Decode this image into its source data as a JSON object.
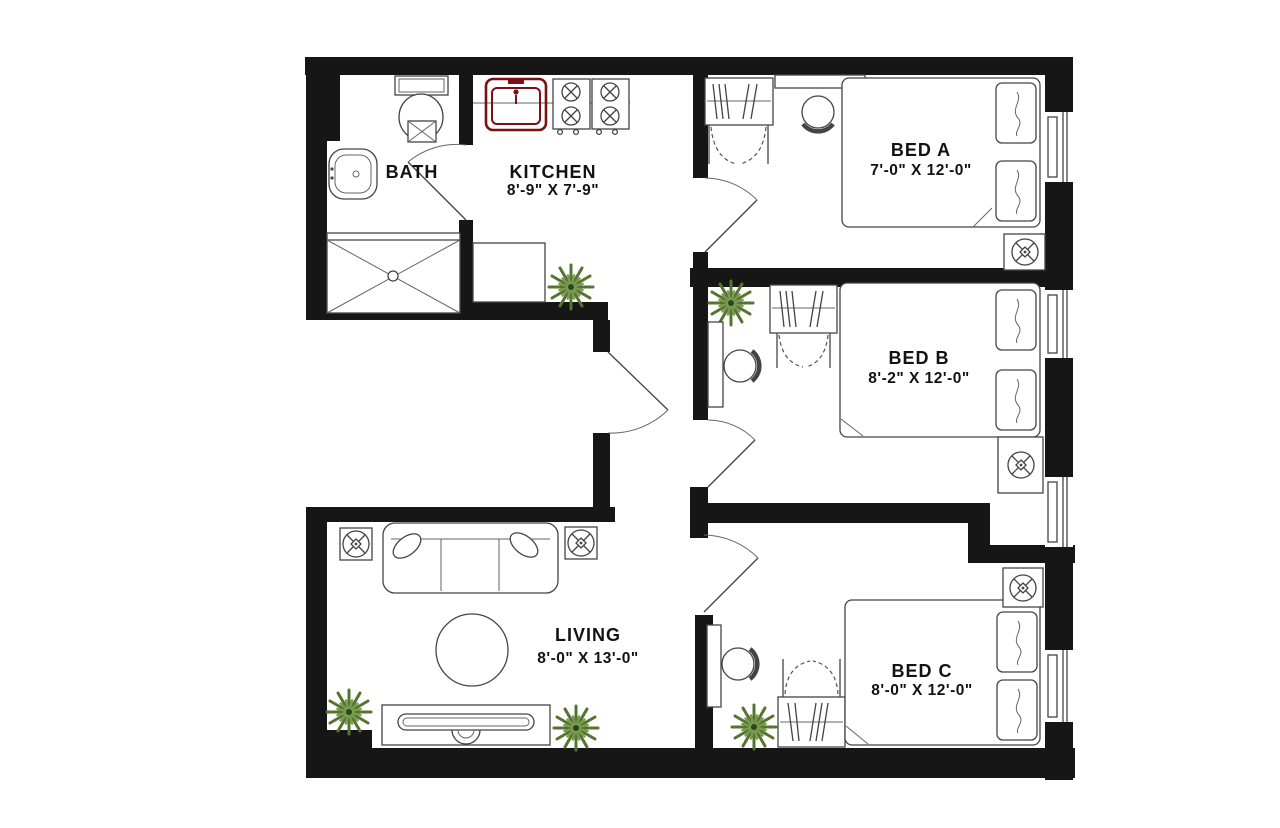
{
  "floorplan": {
    "title": "apartment-floor-plan",
    "rooms": [
      {
        "key": "bath",
        "name": "BATH",
        "dims": ""
      },
      {
        "key": "kitchen",
        "name": "KITCHEN",
        "dims": "8'-9\" X 7'-9\""
      },
      {
        "key": "bed-a",
        "name": "BED A",
        "dims": "7'-0\" X 12'-0\""
      },
      {
        "key": "bed-b",
        "name": "BED B",
        "dims": "8'-2\" X 12'-0\""
      },
      {
        "key": "bed-c",
        "name": "BED C",
        "dims": "8'-0\" X 12'-0\""
      },
      {
        "key": "living",
        "name": "LIVING",
        "dims": "8'-0\" X 13'-0\""
      }
    ],
    "fixtures": {
      "bath": [
        "toilet",
        "sink",
        "shower"
      ],
      "kitchen": [
        "sink",
        "stove",
        "island",
        "plant"
      ],
      "bed_a": [
        "closet",
        "desk",
        "chair",
        "bed",
        "pillows",
        "fan",
        "window"
      ],
      "bed_b": [
        "plant",
        "closet",
        "desk",
        "chair",
        "bed",
        "pillows",
        "fan",
        "windows"
      ],
      "bed_c": [
        "desk",
        "chair",
        "plant",
        "closet",
        "bed",
        "pillows",
        "fan",
        "window"
      ],
      "living": [
        "sofa",
        "throw-pillows",
        "round-table",
        "tv-console",
        "plants",
        "speakers"
      ]
    },
    "colors": {
      "wall": "#161616",
      "linework": "#444444",
      "kitchen_sink_accent": "#7a1214",
      "plant_dark": "#55742e",
      "plant_light": "#7a9b52",
      "background": "#ffffff"
    }
  }
}
